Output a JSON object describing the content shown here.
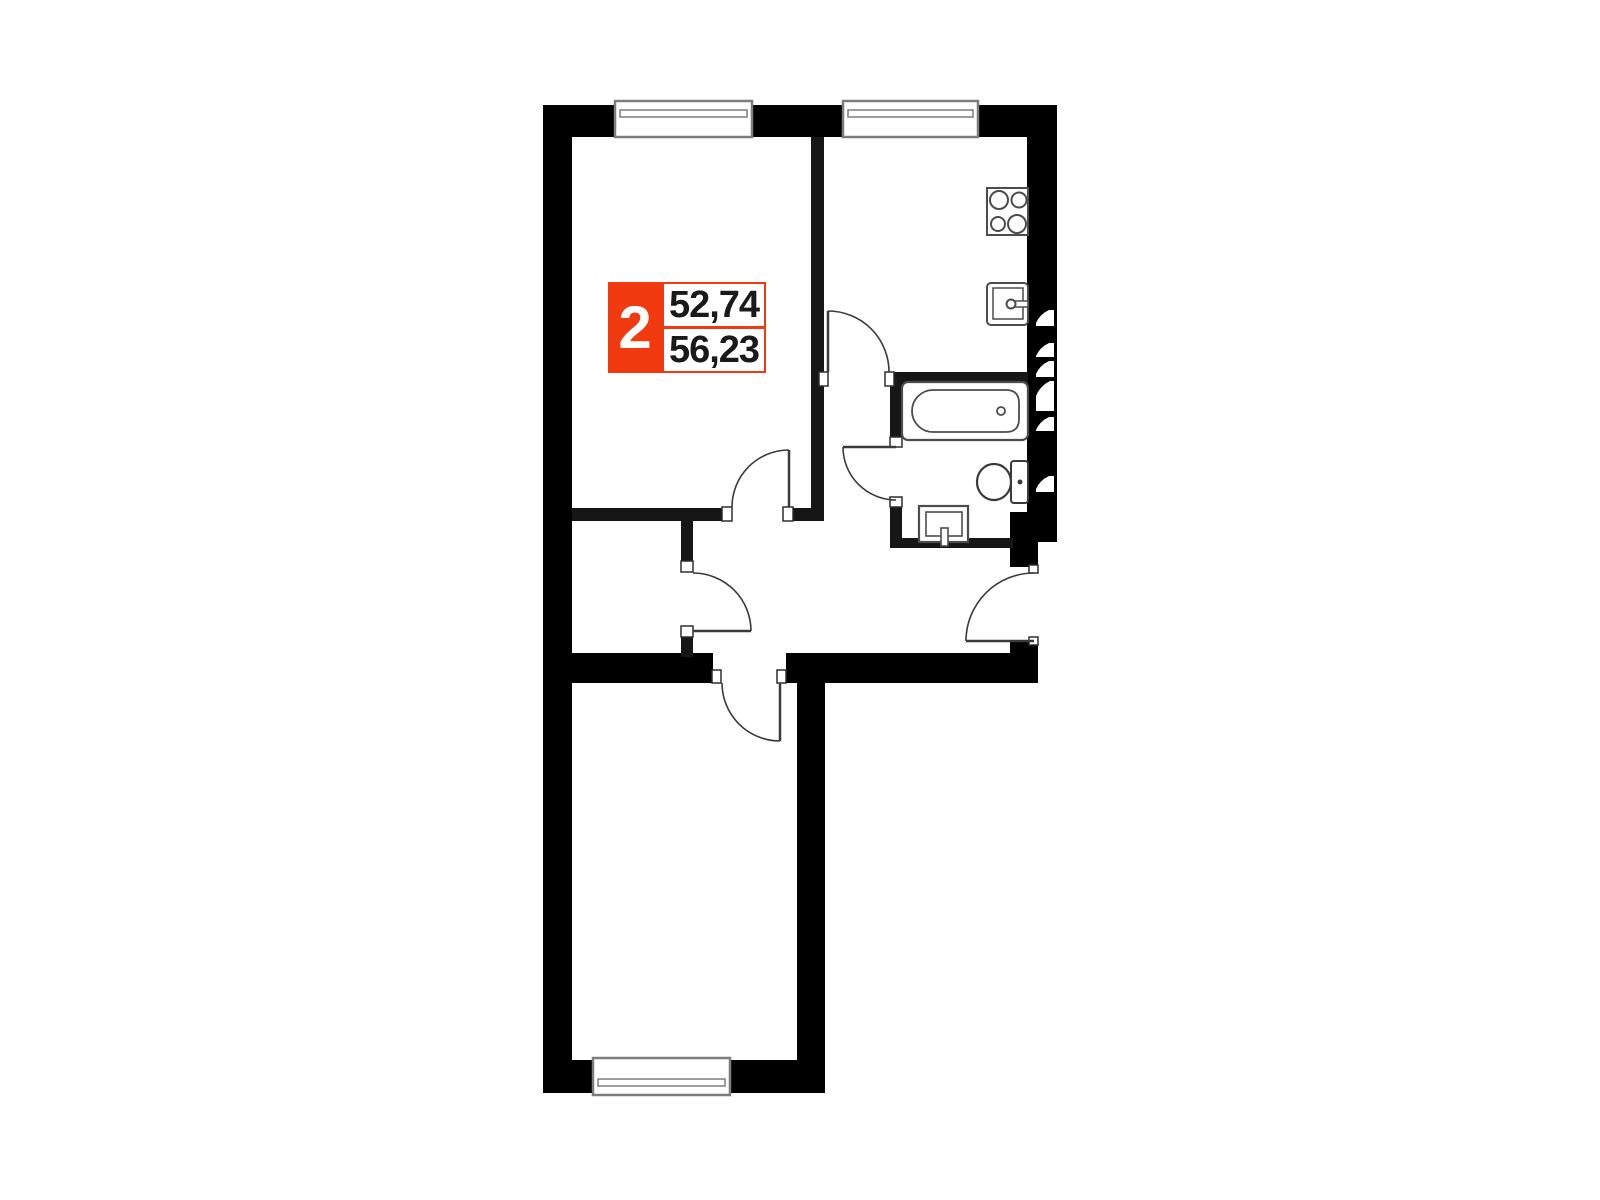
{
  "unit_card": {
    "rooms": "2",
    "area_top": "52,74",
    "area_bottom": "56,23",
    "accent_color": "#F13A10",
    "number_color": "#1A1A1A"
  },
  "plan": {
    "background": "#FFFFFF",
    "exterior_wall_color": "#000000",
    "partition_color": "#161616",
    "window_stroke": "#7D7D7D",
    "fixture_stroke": "#4C4C4C",
    "fixtures": [
      {
        "name": "window",
        "count": 3
      },
      {
        "name": "door-swing",
        "count": 6
      },
      {
        "name": "stove",
        "count": 1
      },
      {
        "name": "kitchen-sink",
        "count": 1
      },
      {
        "name": "bathtub",
        "count": 1
      },
      {
        "name": "toilet",
        "count": 1
      },
      {
        "name": "washbasin",
        "count": 1
      },
      {
        "name": "ventilation-shaft",
        "count": 6
      }
    ]
  }
}
